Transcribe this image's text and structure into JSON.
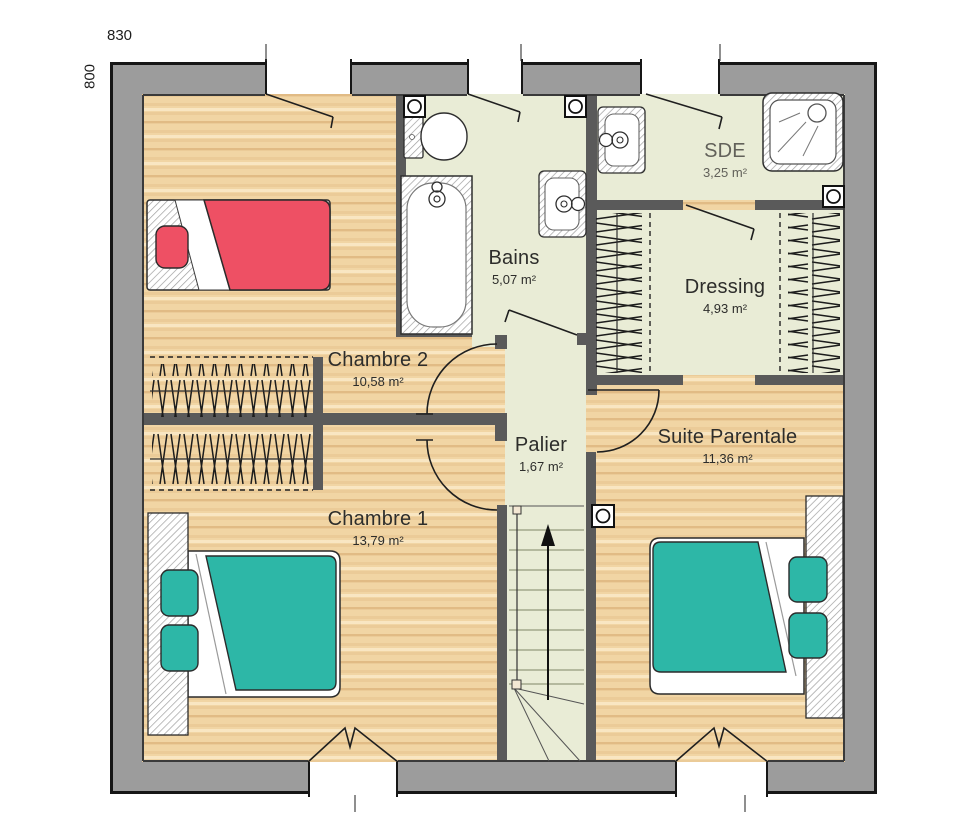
{
  "dimensions": {
    "width_label": "830",
    "height_label": "800"
  },
  "rooms": [
    {
      "name": "Chambre 2",
      "area": "10,58 m²"
    },
    {
      "name": "Bains",
      "area": "5,07 m²"
    },
    {
      "name": "SDE",
      "area": "3,25 m²"
    },
    {
      "name": "Dressing",
      "area": "4,93 m²"
    },
    {
      "name": "Palier",
      "area": "1,67 m²"
    },
    {
      "name": "Suite Parentale",
      "area": "11,36 m²"
    },
    {
      "name": "Chambre 1",
      "area": "13,79 m²"
    }
  ],
  "colors": {
    "wall_outer": "#9c9c9c",
    "wall_inner": "#5a5a5a",
    "floor_wood": "#f1d5a4",
    "floor_wet": "#e9ecd6",
    "bed_primary": "#2db7a7",
    "bed_accent": "#ee5064"
  }
}
